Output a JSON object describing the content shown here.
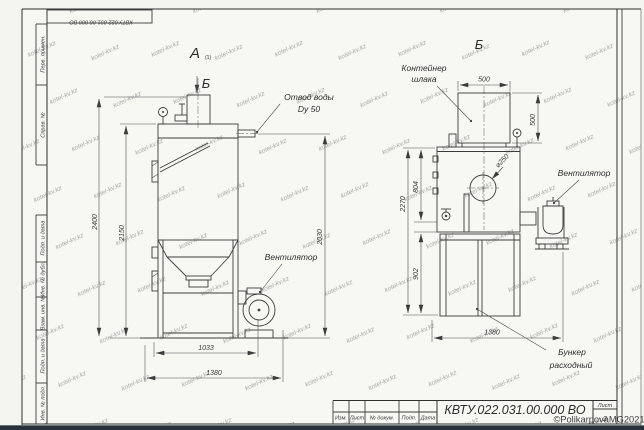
{
  "sheet": {
    "top_designation": "КВТУ.022.031.00.000 ВО",
    "margin_labels": [
      "Перв. примен.",
      "Справ. №",
      "Подп. и дата",
      "Инв. № дубл.",
      "Взам. инв. №",
      "Подп. и дата",
      "Инв. № подл."
    ],
    "watermark_tile": "kotel-kv.kz",
    "watermark_credit": "©PolikarpovaMG2021",
    "line_color": "#3c3c3c",
    "credit_color": "#bb8a3c"
  },
  "views": {
    "left": {
      "label": "А",
      "label_sub": "(1)",
      "section_mark": "Б",
      "callouts": {
        "water_outlet_1": "Отвод воды",
        "water_outlet_2": "Dy 50",
        "fan": "Вентилятор"
      },
      "dims": {
        "h_total": "2400",
        "h_body": "2150",
        "h_outlet": "2030",
        "w_frame": "1033",
        "w_total": "1380"
      }
    },
    "right": {
      "label": "Б",
      "callouts": {
        "container_1": "Контейнер",
        "container_2": "шлака",
        "fan": "Вентилятор",
        "hopper_1": "Бункер",
        "hopper_2": "расходный",
        "diameter": "⌀250"
      },
      "dims": {
        "container_w": "500",
        "container_h": "500",
        "h_upper": "804",
        "h_total": "2270",
        "h_lower": "902",
        "w_total": "1380"
      }
    }
  },
  "title_block": {
    "designation": "КВТУ.022.031.00.000 ВО",
    "columns": [
      "Изм.",
      "Лист",
      "№ докум.",
      "Подп.",
      "Дата"
    ],
    "sheet_label": "Лист",
    "sheet_number": "2"
  }
}
